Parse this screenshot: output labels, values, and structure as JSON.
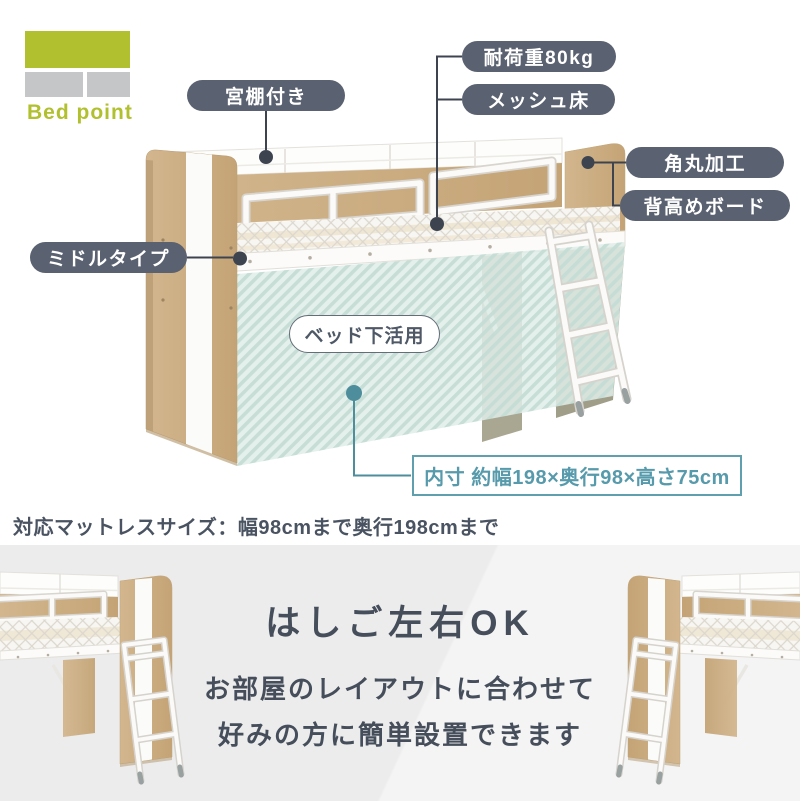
{
  "logo": {
    "text": "Bed point"
  },
  "callouts": {
    "shelf": "宮棚付き",
    "load": "耐荷重80kg",
    "mesh_floor": "メッシュ床",
    "rounded": "角丸加工",
    "tall_board": "背高めボード",
    "middle_type": "ミドルタイプ",
    "under_bed": "ベッド下活用",
    "inner_size": "内寸 約幅198×奥行98×高さ75cm"
  },
  "notes": {
    "mattress": "対応マットレスサイズ：幅98cmまで奥行198cmまで"
  },
  "bottom_section": {
    "title": "はしご左右OK",
    "description_line1": "お部屋のレイアウトに合わせて",
    "description_line2": "好みの方に簡単設置できます"
  },
  "colors": {
    "pill_bg": "#5a6170",
    "pill_text": "#ffffff",
    "accent_teal_border": "#5f9fae",
    "accent_teal_text": "#569aab",
    "teal_dot": "#4e8d9c",
    "stripe_bg": "#e3efeb",
    "stripe_line": "#c5ddd6",
    "wood": "#cdb086",
    "logo_green": "#b1c02f",
    "logo_gray": "#c5c6c8",
    "dark_text": "#4a5361",
    "bottom_band_bg": "#ececed",
    "connector": "#3d4450"
  }
}
